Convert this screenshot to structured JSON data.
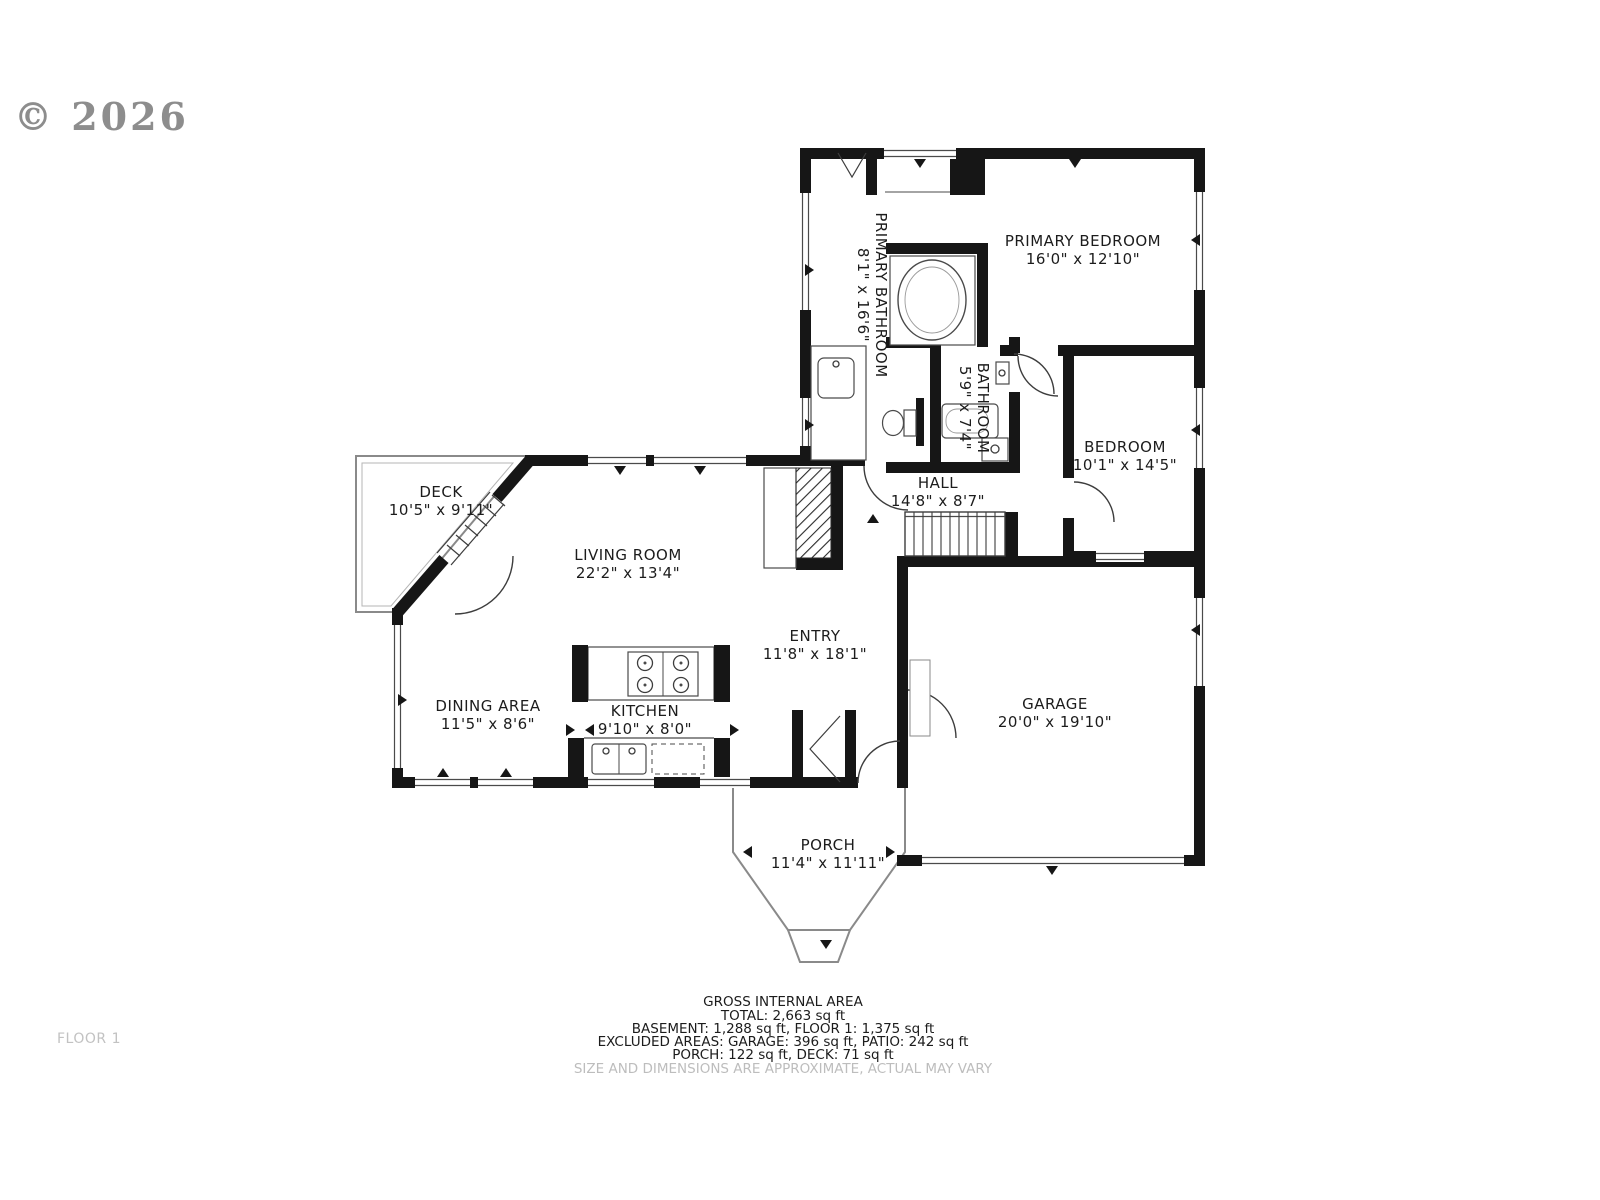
{
  "copyright": "© 2026",
  "floor_label": "FLOOR 1",
  "rooms": {
    "primary_bedroom": {
      "name": "PRIMARY BEDROOM",
      "dims": "16'0\" x 12'10\""
    },
    "primary_bathroom": {
      "name": "PRIMARY BATHROOM",
      "dims": "8'1\" x 16'6\""
    },
    "bathroom": {
      "name": "BATHROOM",
      "dims": "5'9\" x 7'4\""
    },
    "bedroom": {
      "name": "BEDROOM",
      "dims": "10'1\" x 14'5\""
    },
    "hall": {
      "name": "HALL",
      "dims": "14'8\" x 8'7\""
    },
    "deck": {
      "name": "DECK",
      "dims": "10'5\" x 9'11\""
    },
    "living_room": {
      "name": "LIVING ROOM",
      "dims": "22'2\" x 13'4\""
    },
    "dining_area": {
      "name": "DINING AREA",
      "dims": "11'5\" x 8'6\""
    },
    "kitchen": {
      "name": "KITCHEN",
      "dims": "9'10\" x 8'0\""
    },
    "entry": {
      "name": "ENTRY",
      "dims": "11'8\" x 18'1\""
    },
    "garage": {
      "name": "GARAGE",
      "dims": "20'0\" x 19'10\""
    },
    "porch": {
      "name": "PORCH",
      "dims": "11'4\" x 11'11\""
    }
  },
  "footer": {
    "title": "GROSS INTERNAL AREA",
    "total": "TOTAL: 2,663 sq ft",
    "line1": "BASEMENT: 1,288 sq ft, FLOOR 1: 1,375 sq ft",
    "line2": "EXCLUDED AREAS: GARAGE: 396 sq ft, PATIO: 242 sq ft",
    "line3": "PORCH: 122 sq ft, DECK: 71 sq ft",
    "disclaimer": "SIZE AND DIMENSIONS ARE APPROXIMATE, ACTUAL MAY VARY"
  },
  "colors": {
    "wall": "#161616",
    "text": "#1c1c1c",
    "muted": "#bdbdbd"
  }
}
